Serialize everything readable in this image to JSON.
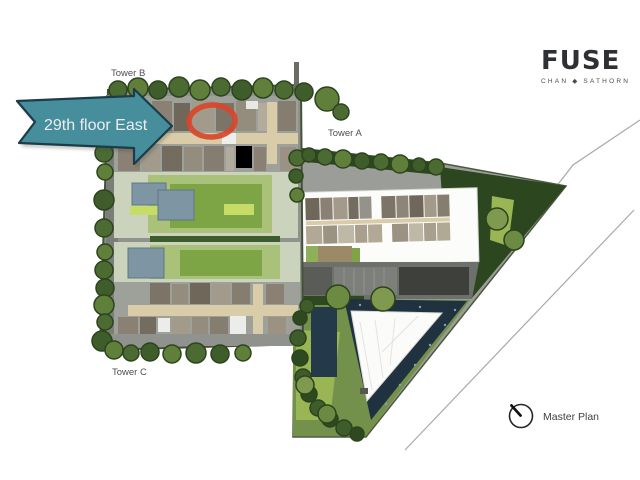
{
  "annotation": {
    "label": "29th floor East"
  },
  "labels": {
    "tower_b": "Tower B",
    "tower_a": "Tower A",
    "tower_c": "Tower C"
  },
  "logo": {
    "name": "FUSE",
    "subtitle": "CHAN ◆ SATHORN"
  },
  "compass": {
    "label": "Master Plan"
  },
  "colors": {
    "arrow_teal": "#468e9b",
    "arrow_outline": "#1d3b48",
    "arrow_text": "#e9edef",
    "highlight_red": "#d8472b",
    "pool_dark": "#203140",
    "pool_light": "#7e95a3",
    "lawn_green": "#7da445",
    "tree_green": "#4c6b33"
  }
}
